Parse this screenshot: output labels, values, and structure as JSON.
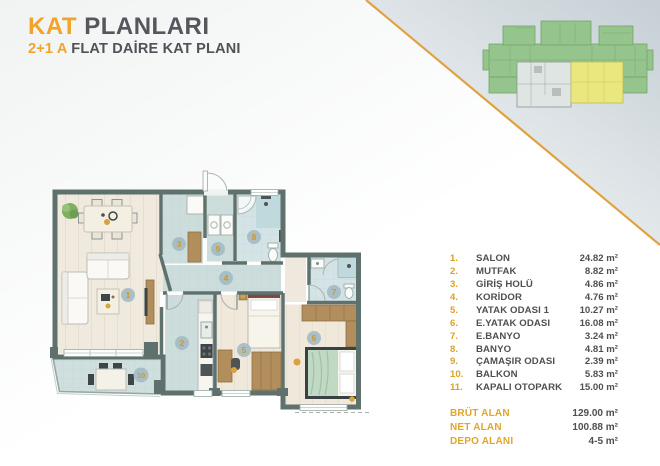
{
  "header": {
    "title_accent": "KAT",
    "title_rest": " PLANLARI",
    "subtitle_accent": "2+1 A",
    "subtitle_rest": " FLAT DAİRE KAT PLANI"
  },
  "legend": {
    "rooms": [
      {
        "no": "1.",
        "name": "SALON",
        "area": "24.82 m²"
      },
      {
        "no": "2.",
        "name": "MUTFAK",
        "area": "8.82 m²"
      },
      {
        "no": "3.",
        "name": "GİRİŞ HOLÜ",
        "area": "4.86 m²"
      },
      {
        "no": "4.",
        "name": "KORİDOR",
        "area": "4.76 m²"
      },
      {
        "no": "5.",
        "name": "YATAK ODASI 1",
        "area": "10.27 m²"
      },
      {
        "no": "6.",
        "name": "E.YATAK ODASI",
        "area": "16.08 m²"
      },
      {
        "no": "7.",
        "name": "E.BANYO",
        "area": "3.24 m²"
      },
      {
        "no": "8.",
        "name": "BANYO",
        "area": "4.81 m²"
      },
      {
        "no": "9.",
        "name": "ÇAMAŞIR ODASI",
        "area": "2.39 m²"
      },
      {
        "no": "10.",
        "name": "BALKON",
        "area": "5.83 m²"
      },
      {
        "no": "11.",
        "name": "KAPALI OTOPARK",
        "area": "15.00 m²"
      }
    ],
    "totals": [
      {
        "label": "BRÜT ALAN",
        "value": "129.00 m²"
      },
      {
        "label": "NET ALAN",
        "value": "100.88 m²"
      },
      {
        "label": "DEPO ALANI",
        "value": "4-5 m²"
      }
    ]
  },
  "plan": {
    "badges": [
      "1",
      "2",
      "3",
      "4",
      "5",
      "6",
      "7",
      "8",
      "9",
      "10"
    ]
  },
  "colors": {
    "accent_gold": "#F0A42A",
    "legend_number_gold": "#DFA026",
    "text_dark": "#55575C",
    "wall": "#5E716D",
    "floor_tile": "#CCDDDC",
    "floor_wood": "#F0E9DD",
    "floor_bath": "#D4E4E6",
    "badge_circle": "#A5BBC4",
    "badge_number": "#D4991F",
    "furniture_brown": "#B28E5C",
    "bed_green": "#BFD9C4",
    "keyplan_green": "#96C48D",
    "keyplan_highlight": "#EAE77F",
    "diagonal_line": "#DFA23E",
    "corner_gradient": "#C5CFD5"
  }
}
